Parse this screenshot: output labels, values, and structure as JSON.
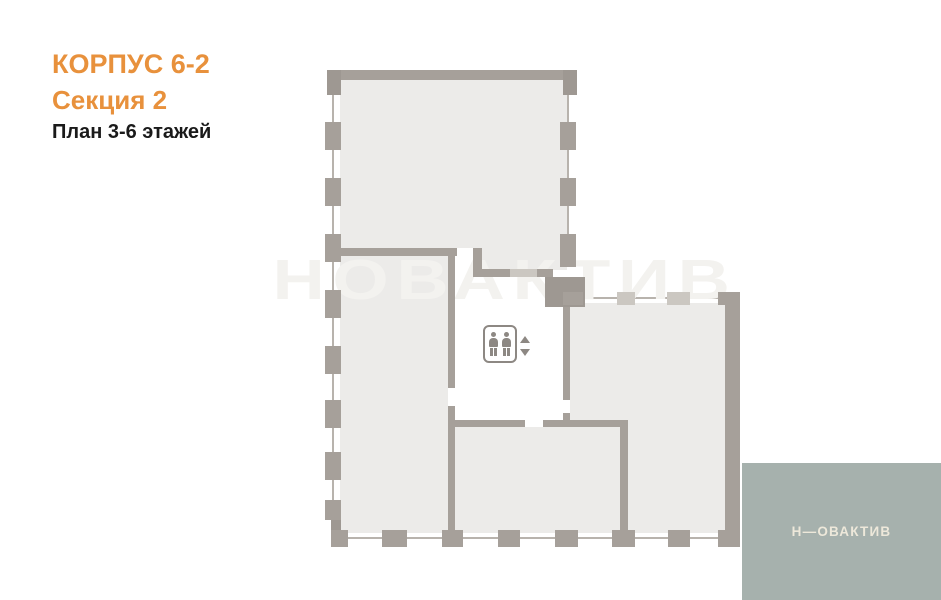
{
  "header": {
    "building": "КОРПУС 6-2",
    "section": "Секция 2",
    "floors": "План 3-6 этажей"
  },
  "watermark": "НОВАКТИВ",
  "brand": {
    "logo_text": "Н—ОВАКТИВ"
  },
  "icons": {
    "elevator": "elevator-passengers-icon",
    "up": "arrow-up-icon",
    "down": "arrow-down-icon"
  },
  "colors": {
    "accent_orange": "#E8913C",
    "text_black": "#1A1A1A",
    "wall_gray": "#A6A09A",
    "corner_gray": "#9E9892",
    "light_pier": "#CBC7C1",
    "room_fill": "#ECEBE9",
    "window_line": "#B8B3AD",
    "watermark_gray": "#F3F2EF",
    "logo_bg": "#A6B1AD",
    "logo_text": "#EDE8DA",
    "elevator_gray": "#8D8883"
  }
}
